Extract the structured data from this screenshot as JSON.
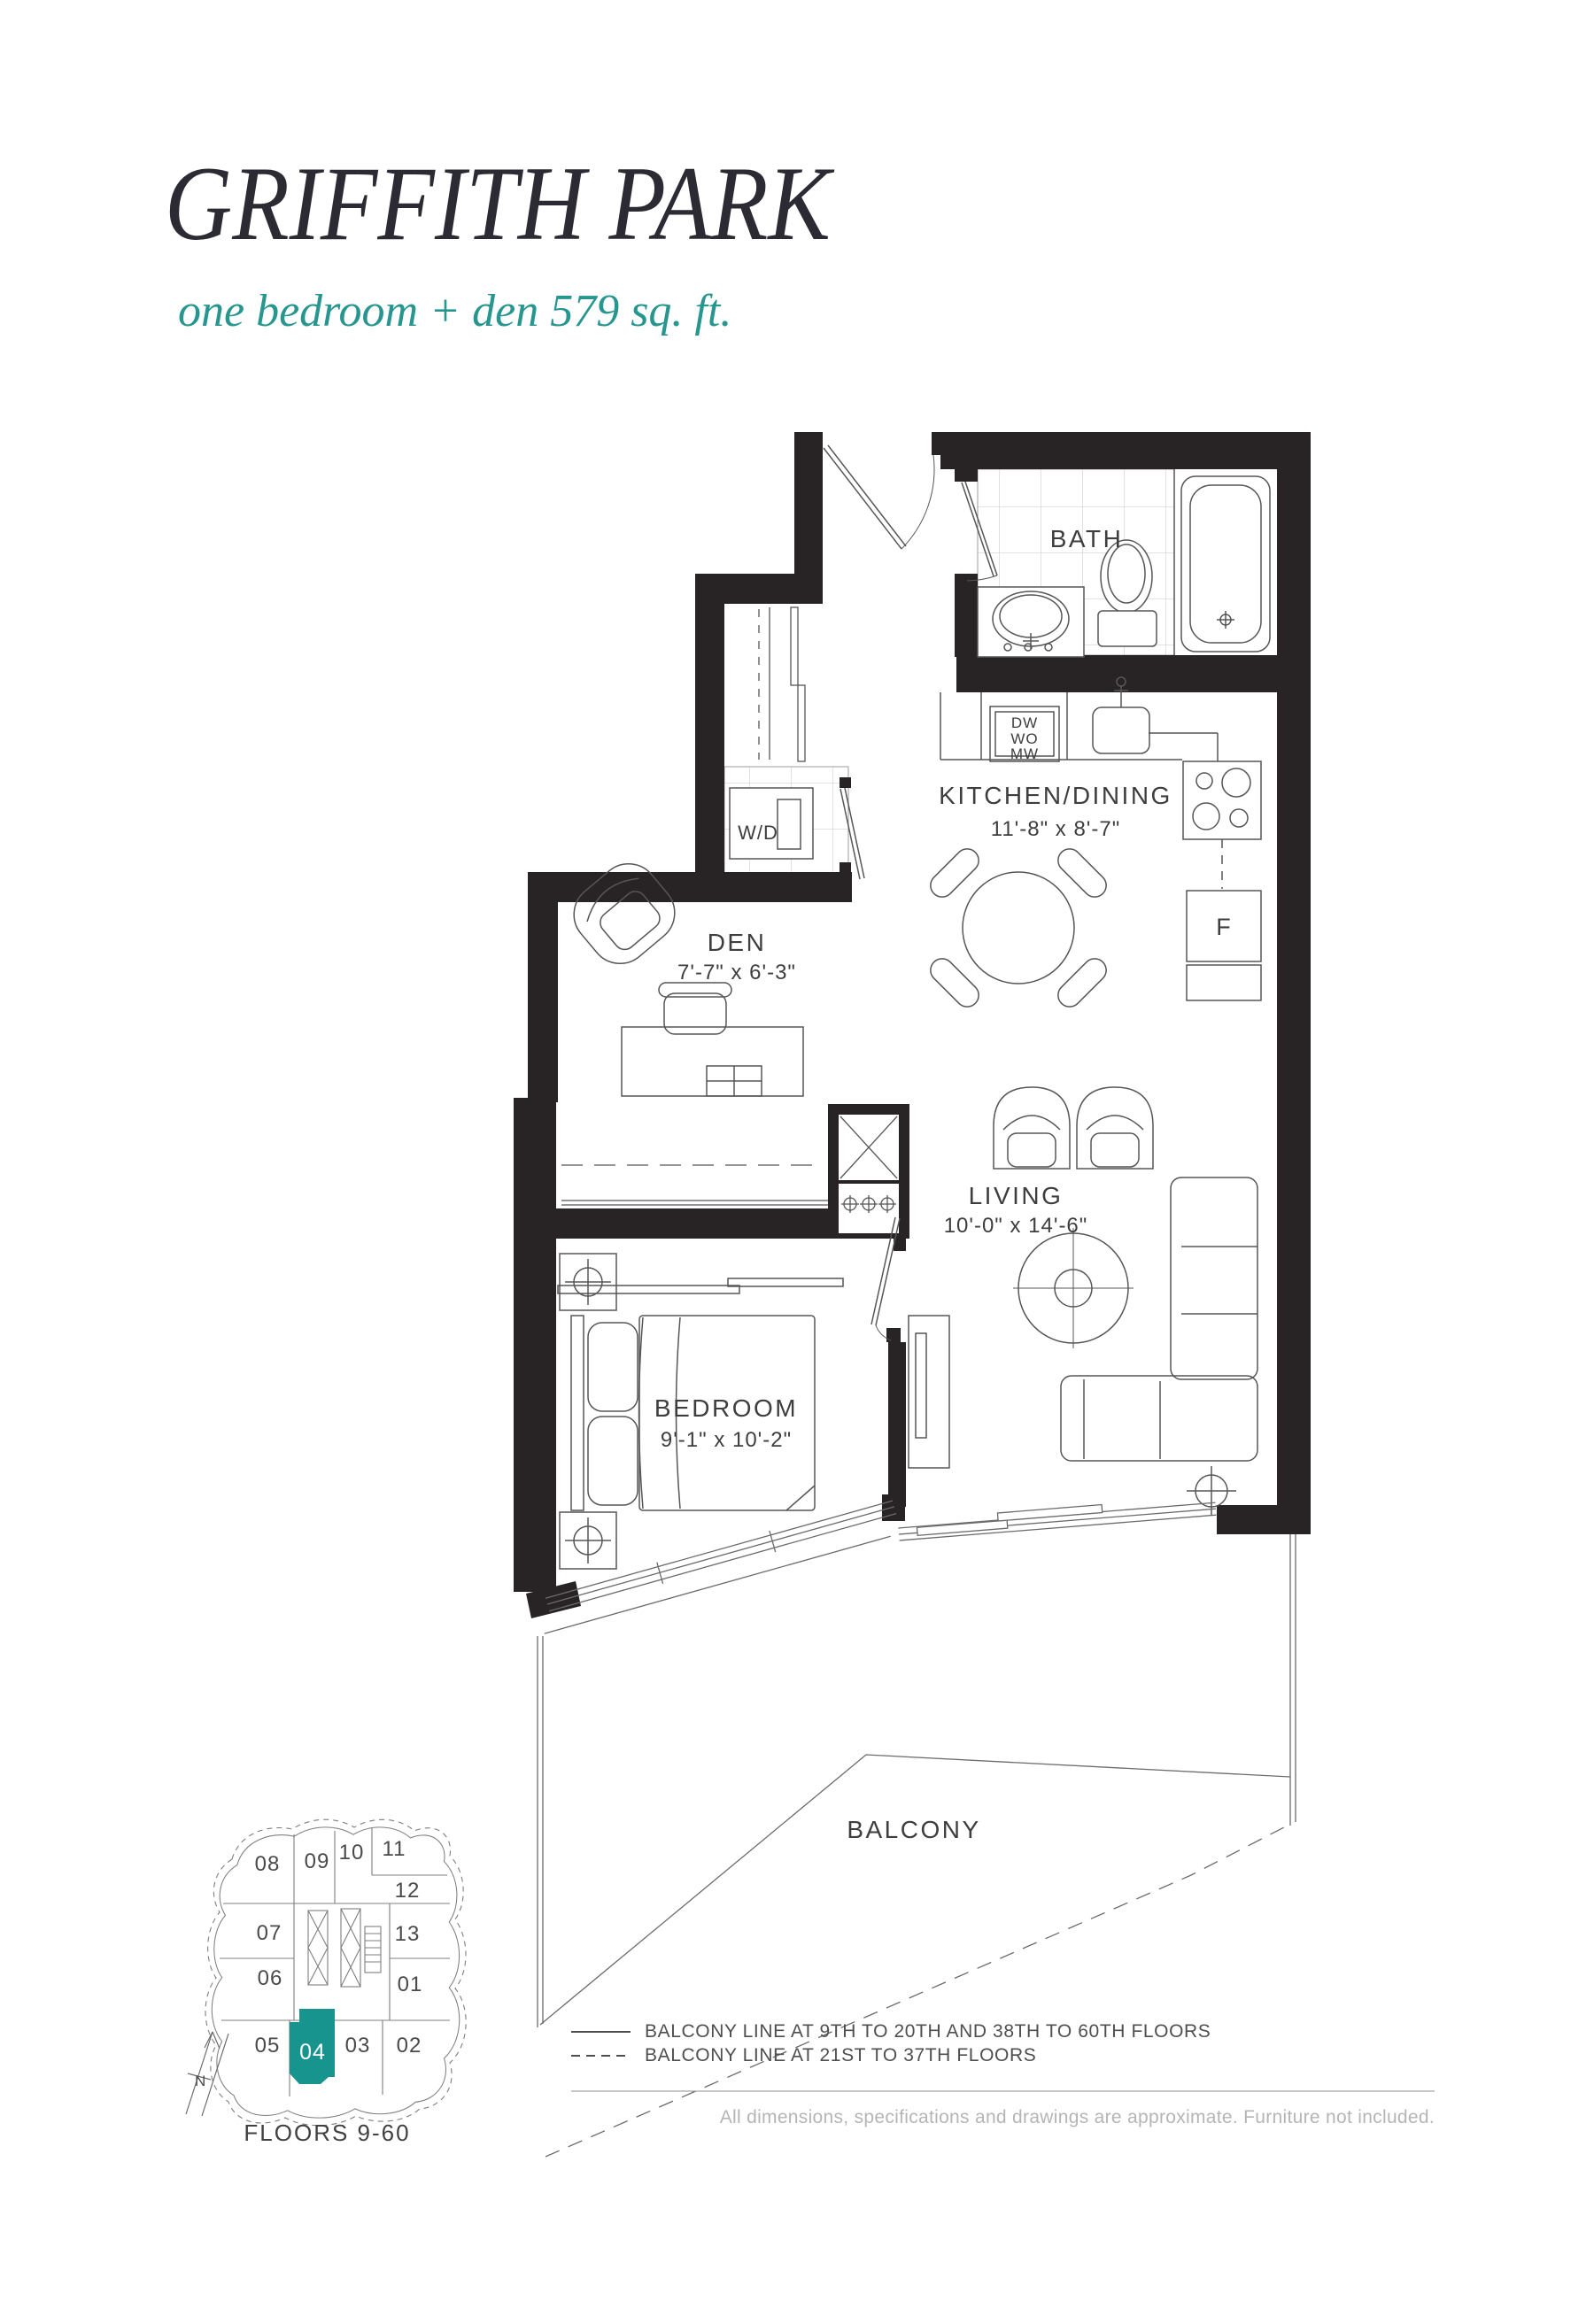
{
  "header": {
    "title": "GRIFFITH PARK",
    "subtitle": "one bedroom + den 579 sq. ft."
  },
  "plan": {
    "rooms": {
      "bath": {
        "name": "BATH"
      },
      "kitchen": {
        "name": "KITCHEN/DINING",
        "dims": "11'-8\" x 8'-7\""
      },
      "den": {
        "name": "DEN",
        "dims": "7'-7\" x 6'-3\""
      },
      "living": {
        "name": "LIVING",
        "dims": "10'-0\" x 14'-6\""
      },
      "bedroom": {
        "name": "BEDROOM",
        "dims": "9'-1\" x 10'-2\""
      },
      "balcony": {
        "name": "BALCONY"
      }
    },
    "labels": {
      "washer_dryer": "W/D",
      "dishwasher": "DW",
      "wall_oven": "WO",
      "microwave": "MW",
      "fridge": "F"
    }
  },
  "keyplan": {
    "units": [
      "08",
      "09",
      "10",
      "11",
      "12",
      "07",
      "13",
      "06",
      "01",
      "05",
      "04",
      "03",
      "02"
    ],
    "highlighted_unit": "04",
    "highlight_color": "#17948E",
    "floors_label": "FLOORS 9-60",
    "north_label": "N"
  },
  "legend": {
    "items": [
      {
        "style": "solid",
        "label": "BALCONY LINE AT 9TH TO 20TH AND 38TH TO 60TH FLOORS"
      },
      {
        "style": "dashed",
        "label": "BALCONY LINE AT 21ST TO 37TH FLOORS"
      }
    ]
  },
  "footer": {
    "disclaimer": "All dimensions, specifications and drawings are approximate. Furniture not included."
  }
}
